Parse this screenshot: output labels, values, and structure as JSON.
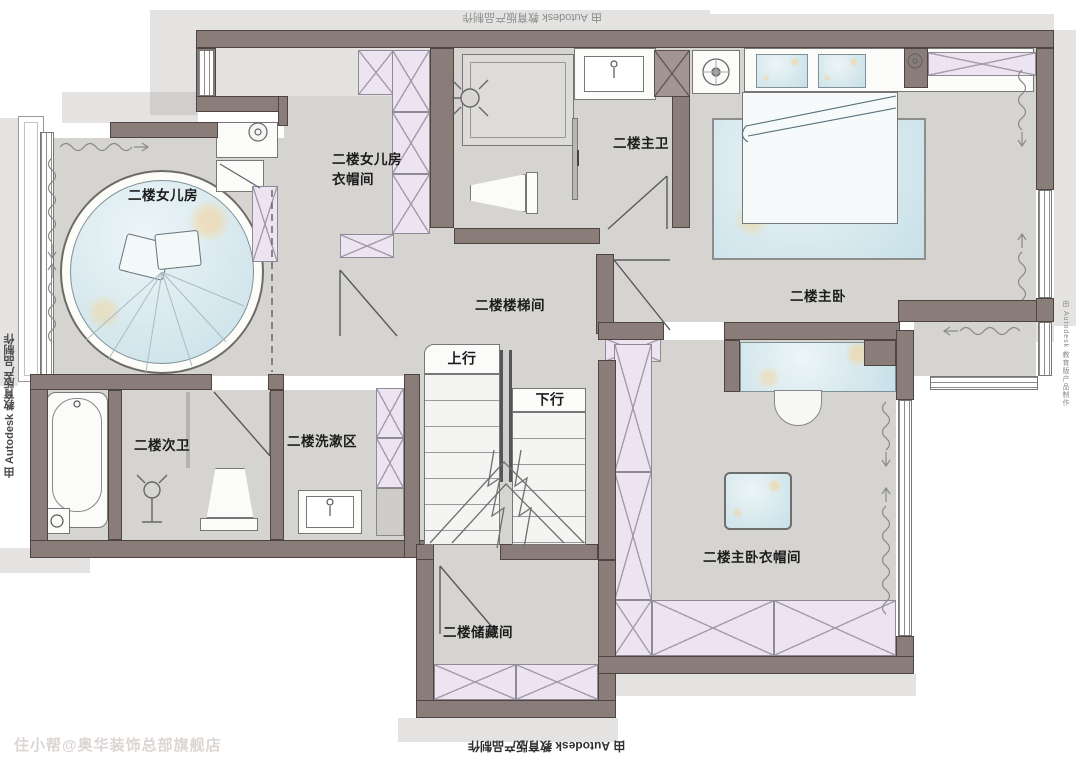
{
  "plan": {
    "rooms": {
      "daughter_room": "二楼女儿房",
      "daughter_closet": "二楼女儿房\n衣帽间",
      "master_bath": "二楼主卫",
      "master_bedroom": "二楼主卧",
      "stairwell": "二楼楼梯间",
      "second_bath": "二楼次卫",
      "washing_area": "二楼洗漱区",
      "storage": "二楼储藏间",
      "master_closet": "二楼主卧衣帽间"
    },
    "stairs": {
      "up": "上行",
      "down": "下行"
    },
    "watermarks": {
      "autodesk": "由 Autodesk 教育版产品制作",
      "shop": "住小帮@奥华装饰总部旗舰店"
    },
    "colors": {
      "wall": "#8a7c79",
      "floor": "#d6d4d1",
      "wardrobe": "#ece4f1",
      "furniture_blue": "#d7e8ee",
      "shadow": "#c7c5c2",
      "label_text": "#1c1c1c"
    }
  }
}
